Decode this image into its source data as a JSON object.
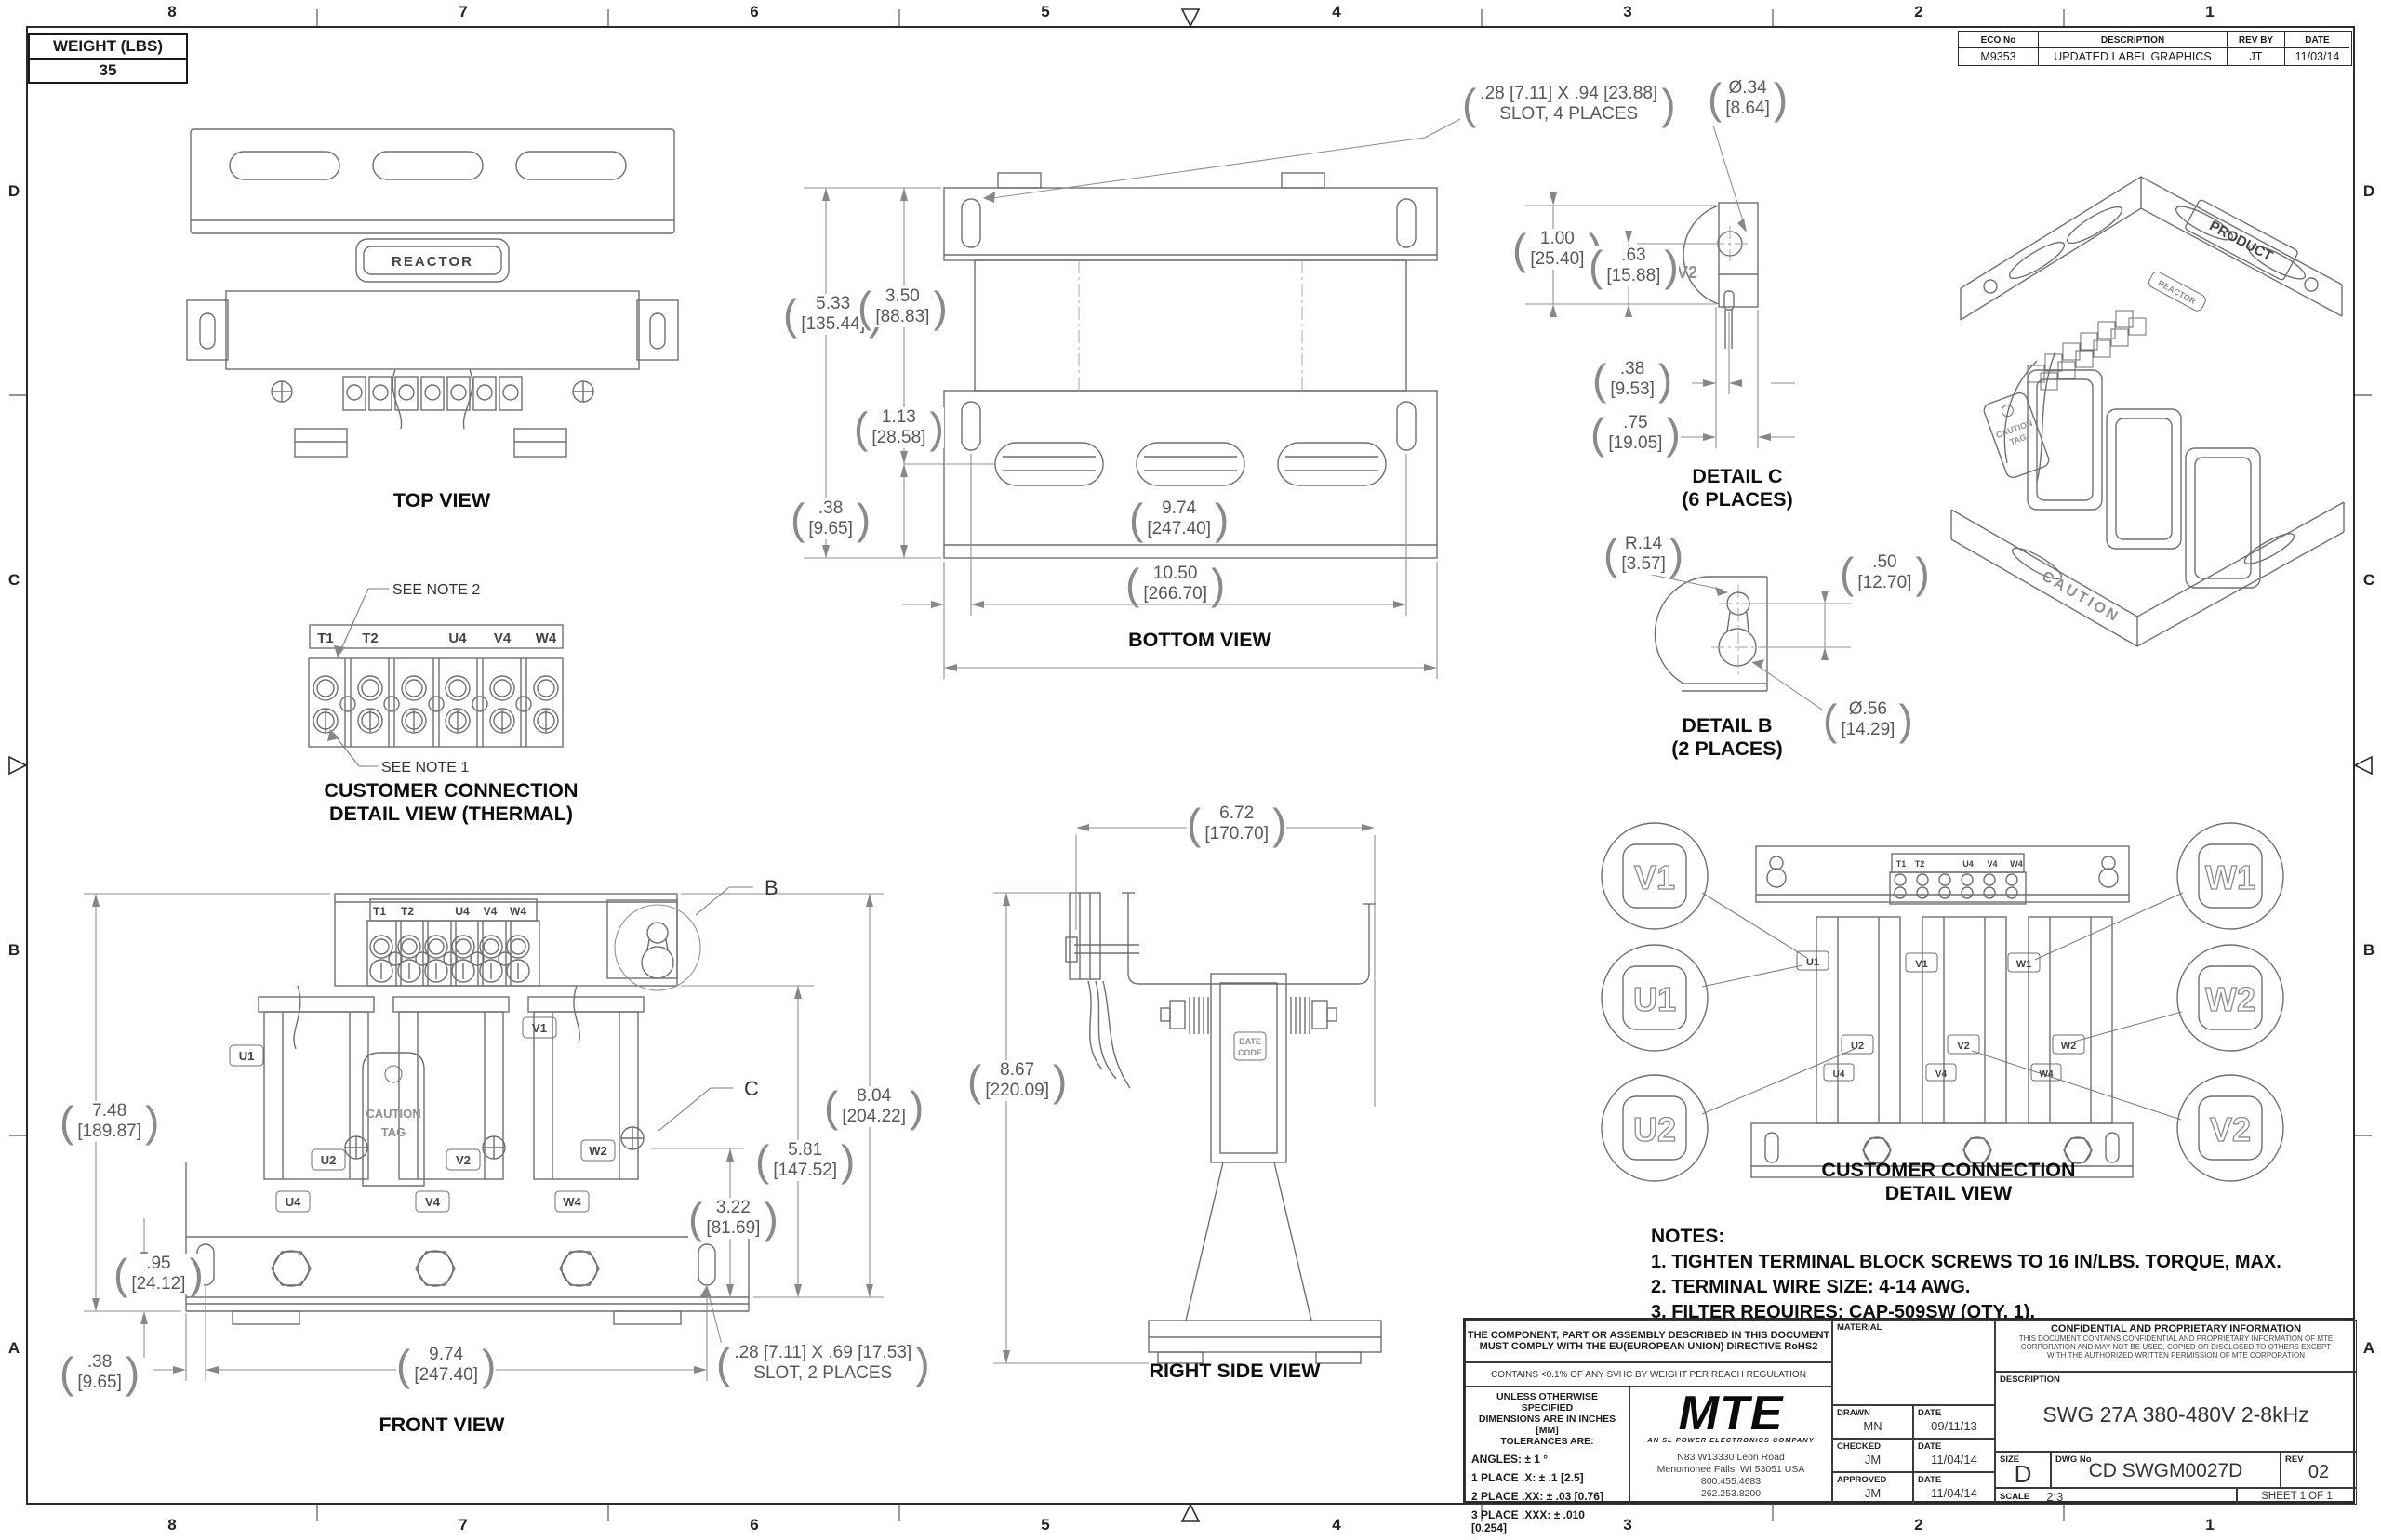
{
  "sheet": {
    "zones_top": [
      "8",
      "7",
      "6",
      "5",
      "4",
      "3",
      "2",
      "1"
    ],
    "zones_bottom": [
      "8",
      "7",
      "6",
      "5",
      "4",
      "3",
      "2",
      "1"
    ],
    "zones_left": [
      "D",
      "C",
      "B",
      "A"
    ],
    "zones_right": [
      "D",
      "C",
      "B",
      "A"
    ]
  },
  "weight_box": {
    "label": "WEIGHT (LBS)",
    "value": "35"
  },
  "eco_table": {
    "headers": {
      "eco": "ECO No",
      "description": "DESCRIPTION",
      "rev_by": "REV BY",
      "date": "DATE"
    },
    "row": {
      "eco": "M9353",
      "description": "UPDATED LABEL GRAPHICS",
      "rev_by": "JT",
      "date": "11/03/14"
    }
  },
  "views": {
    "top_view": {
      "caption": "TOP VIEW",
      "nameplate": "REACTOR"
    },
    "bottom_view": {
      "caption": "BOTTOM VIEW",
      "slot_note_line1": ".28 [7.11] X .94 [23.88]",
      "slot_note_line2": "SLOT, 4 PLACES",
      "dims": {
        "height": {
          "in": "5.33",
          "mm": "[135.44]"
        },
        "height_to_slot": {
          "in": "3.50",
          "mm": "[88.83]"
        },
        "slot_to_edge": {
          "in": "1.13",
          "mm": "[28.58]"
        },
        "edge_offset": {
          "in": ".38",
          "mm": "[9.65]"
        },
        "slot_span": {
          "in": "9.74",
          "mm": "[247.40]"
        },
        "overall_width": {
          "in": "10.50",
          "mm": "[266.70]"
        }
      }
    },
    "detail_c": {
      "caption_line1": "DETAIL C",
      "caption_line2": "(6 PLACES)",
      "body_label": "V2",
      "dims": {
        "hole_dia": {
          "in": "Ø.34",
          "mm": "[8.64]"
        },
        "width": {
          "in": "1.00",
          "mm": "[25.40]"
        },
        "to_hole": {
          "in": ".63",
          "mm": "[15.88]"
        },
        "pin_offset": {
          "in": ".38",
          "mm": "[9.53]"
        },
        "pin_depth": {
          "in": ".75",
          "mm": "[19.05]"
        }
      }
    },
    "detail_b": {
      "caption_line1": "DETAIL B",
      "caption_line2": "(2 PLACES)",
      "dims": {
        "radius": {
          "in": "R.14",
          "mm": "[3.57]"
        },
        "center_dist": {
          "in": ".50",
          "mm": "[12.70]"
        },
        "hole_dia": {
          "in": "Ø.56",
          "mm": "[14.29]"
        }
      }
    },
    "thermal_detail": {
      "caption_line1": "CUSTOMER CONNECTION",
      "caption_line2": "DETAIL VIEW (THERMAL)",
      "note2": "SEE NOTE 2",
      "note1": "SEE NOTE 1",
      "terminals": [
        "T1",
        "T2",
        "U4",
        "V4",
        "W4"
      ]
    },
    "front_view": {
      "caption": "FRONT VIEW",
      "terminals": [
        "T1",
        "T2",
        "U4",
        "V4",
        "W4"
      ],
      "tag_line1": "CAUTION",
      "tag_line2": "TAG",
      "coil_labels": [
        "U1",
        "V1",
        "U2",
        "V2",
        "W2",
        "U4",
        "V4",
        "W4"
      ],
      "callout_b": "B",
      "callout_c": "C",
      "slot_note_line1": ".28 [7.11] X .69 [17.53]",
      "slot_note_line2": "SLOT, 2 PLACES",
      "dims": {
        "overall_height": {
          "in": "7.48",
          "mm": "[189.87]"
        },
        "base_height": {
          "in": ".95",
          "mm": "[24.12]"
        },
        "edge_offset": {
          "in": ".38",
          "mm": "[9.65]"
        },
        "slot_span": {
          "in": "9.74",
          "mm": "[247.40]"
        },
        "bracket_height": {
          "in": "8.04",
          "mm": "[204.22]"
        },
        "mid_height": {
          "in": "5.81",
          "mm": "[147.52]"
        },
        "coil_height": {
          "in": "3.22",
          "mm": "[81.69]"
        }
      }
    },
    "right_side_view": {
      "caption": "RIGHT SIDE VIEW",
      "date_code_line1": "DATE",
      "date_code_line2": "CODE",
      "dims": {
        "depth": {
          "in": "6.72",
          "mm": "[170.70]"
        },
        "overall_height": {
          "in": "8.67",
          "mm": "[220.09]"
        }
      }
    },
    "connection_detail": {
      "caption_line1": "CUSTOMER CONNECTION",
      "caption_line2": "DETAIL VIEW",
      "balloons": [
        "V1",
        "W1",
        "U1",
        "W2",
        "U2",
        "V2"
      ],
      "terminals": [
        "T1",
        "T2",
        "U4",
        "V4",
        "W4"
      ],
      "tab_labels": [
        "U1",
        "V1",
        "W1",
        "U2",
        "V2",
        "W2",
        "U4",
        "V4",
        "W4"
      ]
    },
    "iso_view": {
      "product_label": "PRODUCT",
      "caution": "CAUTION",
      "tag_line1": "CAUTION",
      "tag_line2": "TAG",
      "nameplate": "REACTOR"
    }
  },
  "notes": {
    "heading": "NOTES:",
    "items": [
      "1.  TIGHTEN TERMINAL BLOCK SCREWS TO 16 IN/LBS. TORQUE, MAX.",
      "2.  TERMINAL WIRE SIZE: 4-14 AWG.",
      "3.  FILTER REQUIRES: CAP-509SW (QTY. 1)."
    ]
  },
  "title_block": {
    "compliance_line1": "THE COMPONENT, PART OR ASSEMBLY DESCRIBED IN THIS DOCUMENT",
    "compliance_line2": "MUST COMPLY WITH THE EU(EUROPEAN UNION) DIRECTIVE RoHS2",
    "reach": "CONTAINS <0.1% OF ANY SVHC BY WEIGHT PER REACH REGULATION",
    "tolerances": {
      "line1": "UNLESS OTHERWISE SPECIFIED",
      "line2": "DIMENSIONS ARE IN INCHES [MM]",
      "line3": "TOLERANCES ARE:",
      "angles": "ANGLES: ± 1 °",
      "place1": "1 PLACE .X: ± .1 [2.5]",
      "place2": "2 PLACE .XX: ± .03 [0.76]",
      "place3": "3 PLACE .XXX: ± .010 [0.254]"
    },
    "logo": {
      "text": "MTE",
      "tagline": "AN SL POWER ELECTRONICS COMPANY",
      "address_line1": "N83 W13330 Leon Road",
      "address_line2": "Menomonee Falls, WI 53051 USA",
      "address_line3": "800.455.4683",
      "address_line4": "262.253.8200"
    },
    "material_label": "MATERIAL",
    "drawn": {
      "label": "DRAWN",
      "value": "MN",
      "date_label": "DATE",
      "date": "09/11/13"
    },
    "checked": {
      "label": "CHECKED",
      "value": "JM",
      "date_label": "DATE",
      "date": "11/04/14"
    },
    "approved": {
      "label": "APPROVED",
      "value": "JM",
      "date_label": "DATE",
      "date": "11/04/14"
    },
    "confidential": {
      "heading": "CONFIDENTIAL AND PROPRIETARY INFORMATION",
      "line1": "THIS DOCUMENT CONTAINS CONFIDENTIAL AND PROPRIETARY INFORMATION OF MTE",
      "line2": "CORPORATION AND MAY NOT BE USED, COPIED OR DISCLOSED TO OTHERS EXCEPT",
      "line3": "WITH THE AUTHORIZED WRITTEN PERMISSION OF MTE CORPORATION"
    },
    "description_label": "DESCRIPTION",
    "description": "SWG 27A 380-480V 2-8kHz",
    "size_label": "SIZE",
    "size": "D",
    "dwg_label": "DWG No",
    "dwg_no": "CD SWGM0027D",
    "rev_label": "REV",
    "rev": "02",
    "scale_label": "SCALE",
    "scale": "2:3",
    "sheet": "SHEET 1 OF 1"
  }
}
